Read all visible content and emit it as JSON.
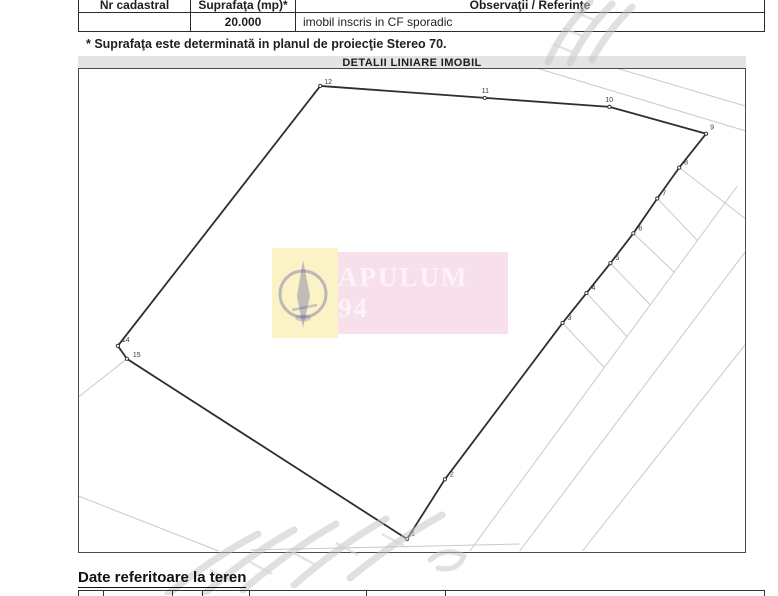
{
  "document": {
    "header_table": {
      "columns": [
        "Nr cadastral",
        "Suprafaţa (mp)*",
        "Observaţii / Referinţe"
      ],
      "values": {
        "nr_cadastral": "",
        "suprafata_mp": "20.000",
        "observatii": "imobil inscris in CF sporadic"
      }
    },
    "footnote": "* Suprafaţa este determinată in planul de proiecţie Stereo 70.",
    "section_heading": "Date referitoare la teren"
  },
  "diagram": {
    "title": "DETALII LINIARE IMOBIL",
    "stamp": {
      "company": "APULUM 94",
      "logo_box_color": "#fbf2c2",
      "text_box_color": "#f7dfec",
      "text_color": "#fdf2f8",
      "logo_color": "#4a4a96"
    },
    "chart_data": {
      "type": "parcel-plan-polygon",
      "parcel_vertices": [
        {
          "label": "12",
          "x": 320,
          "y": 85,
          "lx": 324,
          "ly": 83
        },
        {
          "label": "11",
          "x": 485,
          "y": 97,
          "lx": 482,
          "ly": 92
        },
        {
          "label": "10",
          "x": 610,
          "y": 106,
          "lx": 606,
          "ly": 101
        },
        {
          "label": "9",
          "x": 707,
          "y": 133,
          "lx": 711,
          "ly": 129
        },
        {
          "label": "8",
          "x": 680,
          "y": 167,
          "lx": 685,
          "ly": 164
        },
        {
          "label": "7",
          "x": 658,
          "y": 198,
          "lx": 663,
          "ly": 195
        },
        {
          "label": "6",
          "x": 634,
          "y": 233,
          "lx": 639,
          "ly": 230
        },
        {
          "label": "5",
          "x": 611,
          "y": 263,
          "lx": 616,
          "ly": 260
        },
        {
          "label": "4",
          "x": 587,
          "y": 293,
          "lx": 592,
          "ly": 290
        },
        {
          "label": "3",
          "x": 563,
          "y": 323,
          "lx": 568,
          "ly": 320
        },
        {
          "label": "2",
          "x": 445,
          "y": 480,
          "lx": 450,
          "ly": 477
        },
        {
          "label": "1",
          "x": 407,
          "y": 540,
          "lx": 411,
          "ly": 537
        },
        {
          "label": "15",
          "x": 126,
          "y": 359,
          "lx": 132,
          "ly": 357
        },
        {
          "label": "14",
          "x": 117,
          "y": 346,
          "lx": 121,
          "ly": 342
        }
      ],
      "background_lines": [
        [
          620,
          68,
          746,
          105
        ],
        [
          540,
          68,
          746,
          130
        ],
        [
          738,
          186,
          470,
          552
        ],
        [
          746,
          252,
          520,
          552
        ],
        [
          746,
          345,
          583,
          552
        ],
        [
          680,
          167,
          746,
          218
        ],
        [
          658,
          198,
          698,
          240
        ],
        [
          634,
          233,
          675,
          272
        ],
        [
          611,
          263,
          651,
          305
        ],
        [
          587,
          293,
          628,
          337
        ],
        [
          563,
          323,
          605,
          368
        ],
        [
          78,
          497,
          218,
          552
        ],
        [
          126,
          359,
          78,
          397
        ],
        [
          250,
          551,
          520,
          545
        ]
      ]
    }
  },
  "colors": {
    "parcel_line": "#2e2e2e",
    "faint_line": "#c9c9c9",
    "title_band": "#e4e4e4"
  }
}
